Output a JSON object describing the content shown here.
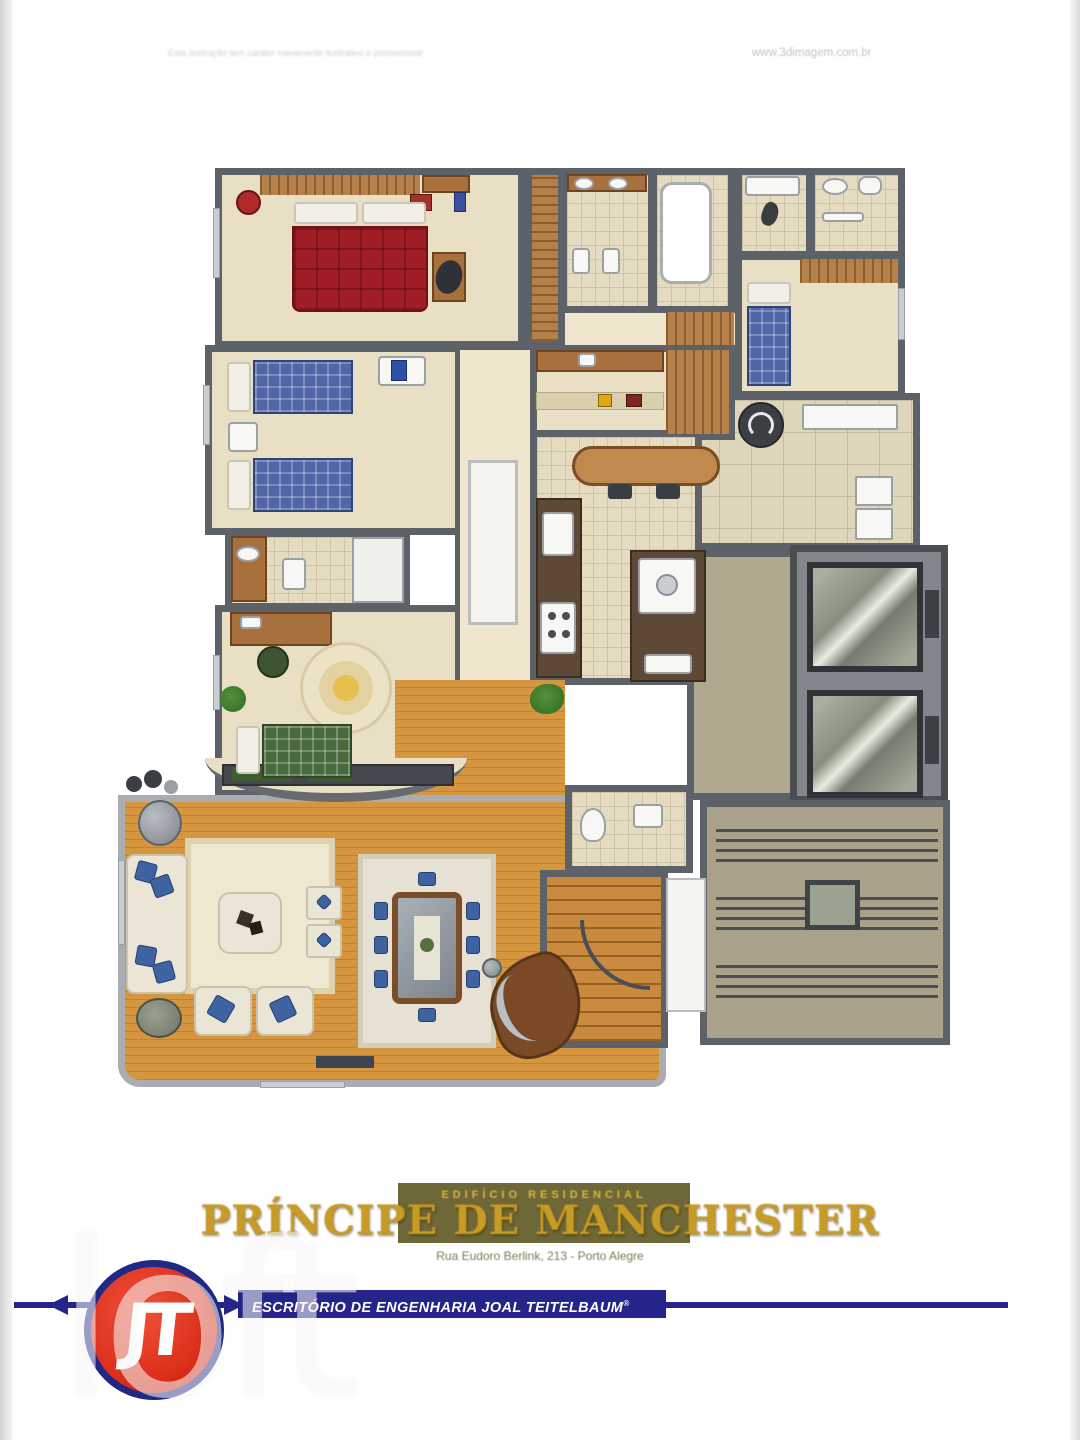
{
  "header": {
    "disclaimer": "Esta ilustração tem caráter meramente ilustrativo e promocional",
    "website": "www.3dimagem.com.br"
  },
  "title_block": {
    "building_type": "EDIFÍCIO RESIDENCIAL",
    "building_name": "PRÍNCIPE DE MANCHESTER",
    "address": "Rua Eudoro Berlink, 213 - Porto Alegre"
  },
  "footer": {
    "company": "ESCRITÓRIO DE ENGENHARIA JOAL TEITELBAUM",
    "trademark": "®",
    "logo_monogram": "JT"
  },
  "watermark": "loft",
  "palette": {
    "wall": "#5d6268",
    "floor_beige": "#e9dfc4",
    "tile": "#e4dbc1",
    "wood": "#d6953f",
    "stone": "#b1a98f",
    "navy": "#24248a",
    "logo_red": "#d92b16",
    "gold": "#c79b25",
    "olive": "#6e6838"
  },
  "floor_plan": {
    "type": "residential apartment floor plan, top-down illustrated view",
    "rooms_depicted": [
      "master bedroom",
      "master bathroom",
      "bathtub room",
      "shower room",
      "second bathroom",
      "maid's room",
      "laundry service area",
      "twin bedroom",
      "third bedroom",
      "hallway",
      "kitchen",
      "breakfast area",
      "service hall",
      "elevator hall",
      "two elevators",
      "common staircase",
      "lavabo",
      "internal winding staircase",
      "living room",
      "dining room",
      "entry"
    ],
    "furnishings_depicted": [
      "red double bed",
      "two blue plaid single beds",
      "blue single bed",
      "green plaid single bed",
      "wardrobes",
      "desk with chair",
      "round rug",
      "kitchen counters with sink and stove",
      "breakfast table with stools",
      "washing machine",
      "water heater",
      "cream sofa set with blue cushions",
      "coffee table",
      "dining table with eight blue chairs",
      "grand piano",
      "plants"
    ]
  }
}
